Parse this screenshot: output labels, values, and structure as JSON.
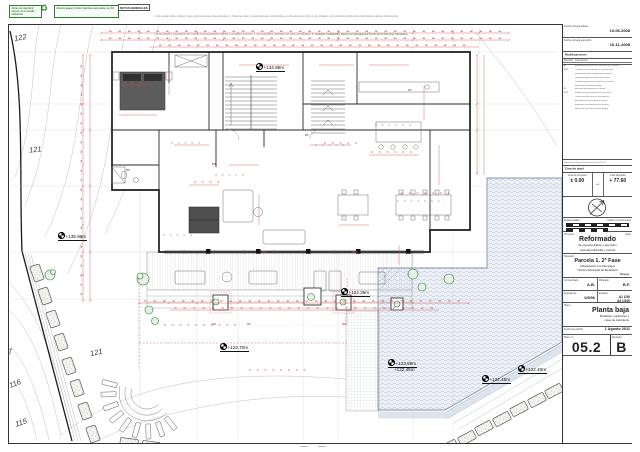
{
  "colors": {
    "accent_red": "#cf4a4a",
    "wall_black": "#1c1c1c",
    "pool_blue": "#9fb3cc",
    "plant_green": "#2e7d32",
    "badge_green": "#2e7d32"
  },
  "top_bar": {
    "badge1": "Antes de imprimir piense en el medio ambiente",
    "badge2": "Ahorre papel y tinta: imprima este plano en A3",
    "notes_title": "NOTAS GENERALES",
    "notes_line1": "1. No escalar sobre el plano: rigen unicamente las cotas acotadas.  2. Todas las cotas y niveles deberan comprobarse en obra antes del inicio de los trabajos, comunicando a la Direccion Facultativa cualquier discrepancia.",
    "notes_line2": "3. Este plano es inseparable del resto de la documentacion grafica y escrita del proyecto.  4. Las superficies indicadas son utiles aproximadas.",
    "notes_line3": "5. Cualquier modificacion debera ser aprobada por escrito por la Direccion Facultativa."
  },
  "title_block": {
    "delivery": [
      {
        "label": "Fecha entrega básico",
        "value": "10-06-2008"
      },
      {
        "label": "Fecha entrega ejecución",
        "value": "16-11-2008"
      }
    ],
    "revisions": {
      "title": "Modificaciones",
      "col_rev": "Revisión",
      "col_desc": "Descripción",
      "rows": [
        {
          "rev": "A",
          "desc": "Ampliación de porche en alzado sur y piscina"
        },
        {
          "rev": "6/11",
          "desc": "Cambios de distribución en planta baja"
        },
        {
          "rev": "",
          "desc": "Modificación de carpinterías exteriores"
        },
        {
          "rev": "",
          "desc": "Nueva distribución de cocina y office"
        },
        {
          "rev": "",
          "desc": "Cambio de solería en porches y terrazas"
        },
        {
          "rev": "",
          "desc": "Ajuste de escalera principal"
        },
        {
          "rev": "B",
          "desc": "Revisión de mobiliario en salón"
        },
        {
          "rev": "4/11",
          "desc": "Ampliación de pérgola junto a piscina"
        },
        {
          "rev": "",
          "desc": "Corrección de cotas en fachada sur"
        },
        {
          "rev": "",
          "desc": "Actualización de superficies útiles"
        },
        {
          "rev": "",
          "desc": "Replanteo de jardineras en terraza"
        },
        {
          "rev": "",
          "desc": "Ajuste de vaso de piscina y playas"
        }
      ],
      "footnote": "Replanteo sobre parcela con fecha 6-05-11"
    },
    "level": {
      "title": "Cota de nivel",
      "relative_label": "Cota de proyecto",
      "relative_value": "± 0.00",
      "absolute_label": "Cota absoluta",
      "absolute_value": "+ 77.60"
    },
    "scale_bar": {
      "label": "Escala gráfica",
      "units": "Cotas en centímetros"
    },
    "project": {
      "label": "Proyecto",
      "fase_label": "Fase",
      "name": "Reformado",
      "line1": "de proyecto básico y ejecución",
      "line2": "vivienda unifamiliar y piscina"
    },
    "location": {
      "label": "Situación",
      "name": "Parcela 1. 2ª Fase",
      "line1": "Urbanización Los Flamingos",
      "line2": "Término Municipal de Benahavís",
      "line3": "Málaga"
    },
    "credits": [
      {
        "label": "Comprobado",
        "value": "A.B."
      },
      {
        "label": "Dibujado",
        "value": "B.F."
      }
    ],
    "file": [
      {
        "label": "Expediente",
        "value": "1/9/96"
      },
      {
        "label": "Escalas",
        "value": "A1 1/50",
        "value2": "A3 1/100"
      }
    ],
    "sheet": {
      "label": "Plano",
      "name": "Planta baja",
      "line1": "Mobiliario, superficies y",
      "line2": "cotas de carpintería"
    },
    "edition": {
      "label": "Fecha de edición",
      "value": "1 Agosto 2011"
    },
    "number": {
      "label": "Plano nº",
      "value": "05.2",
      "rev_label": "Revisión",
      "rev_value": "B"
    }
  },
  "plan": {
    "levels": [
      {
        "text": "+134.95m"
      },
      {
        "text": "+135.90m"
      },
      {
        "text": "+124.39m"
      },
      {
        "text": "+123.70m"
      },
      {
        "text": "+123.89m"
      },
      {
        "text": "+122.45m"
      },
      {
        "text": "+122.45m"
      },
      {
        "text": "+122.40m"
      }
    ],
    "contours": [
      {
        "text": "122"
      },
      {
        "text": "121"
      },
      {
        "text": "121"
      },
      {
        "text": "7"
      },
      {
        "text": "116"
      },
      {
        "text": "115"
      }
    ],
    "tags": [
      {
        "text": "P1"
      },
      {
        "text": "P2"
      },
      {
        "text": "P3"
      },
      {
        "text": "A1"
      },
      {
        "text": "A2"
      },
      {
        "text": "A3"
      },
      {
        "text": "PV1"
      },
      {
        "text": "PV2"
      },
      {
        "text": "V1"
      }
    ]
  }
}
